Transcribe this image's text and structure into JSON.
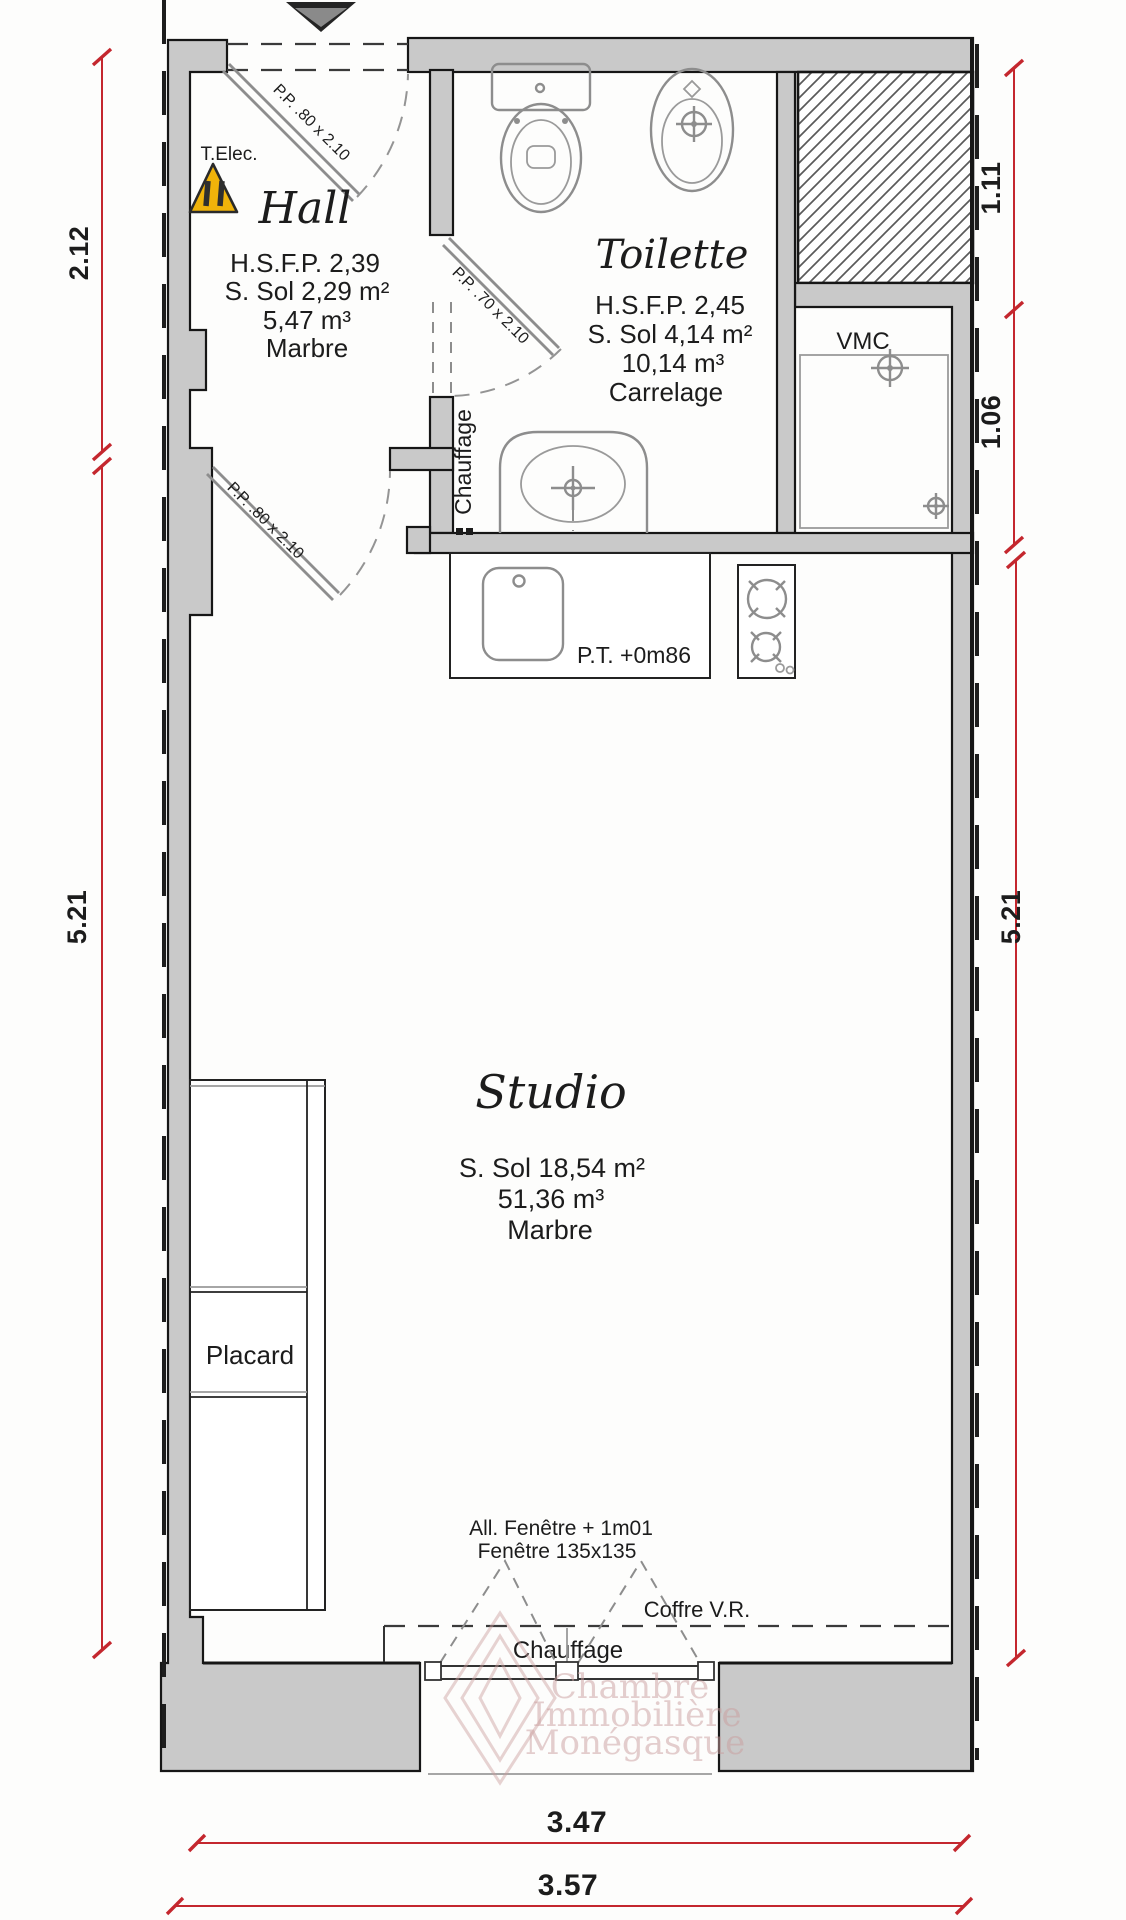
{
  "plan": {
    "type": "apartment-floor-plan",
    "colors": {
      "wall_gray": "#c9c9c9",
      "line_black": "#161616",
      "fixture_gray": "#8d8d8d",
      "dimension_red": "#c4272e",
      "warning_yellow": "#f0b30a",
      "watermark_pink": "#c99d9d"
    }
  },
  "rooms": {
    "hall": {
      "title": "Hall",
      "ceiling": "H.S.F.P. 2,39",
      "surface": "S. Sol 2,29 m²",
      "volume": "5,47 m³",
      "floor": "Marbre"
    },
    "toilette": {
      "title": "Toilette",
      "ceiling": "H.S.F.P. 2,45",
      "surface": "S. Sol 4,14 m²",
      "volume": "10,14 m³",
      "floor": "Carrelage"
    },
    "studio": {
      "title": "Studio",
      "ceiling": "H.S.D. 2,77",
      "surface": "S. Sol 18,54 m²",
      "volume": "51,36 m³",
      "floor": "Marbre"
    }
  },
  "doors": {
    "entrance_door": "P.P. .80 x 2.10",
    "toilette_door": "P.P. .70 x 2.10",
    "studio_door": "P.P. .80 x 2.10"
  },
  "equipment": {
    "t_elec": "T.Elec.",
    "vmc": "VMC",
    "chauffage_toilette": "Chauffage",
    "chauffage_studio": "Chauffage",
    "placard": "Placard",
    "worktop": "P.T. +0m86",
    "coffre": "Coffre V.R.",
    "window_sill": "All. Fenêtre + 1m01",
    "window_size": "Fenêtre 135x135"
  },
  "dimensions": {
    "left_hall": "2.12",
    "left_studio": "5.21",
    "right_upper": "1.11",
    "right_mid": "1.06",
    "right_studio": "5.21",
    "bottom_inner": "3.47",
    "bottom_outer": "3.57"
  },
  "watermark": {
    "line1": "Chambre",
    "line2": "Immobilière",
    "line3": "Monégasque"
  }
}
